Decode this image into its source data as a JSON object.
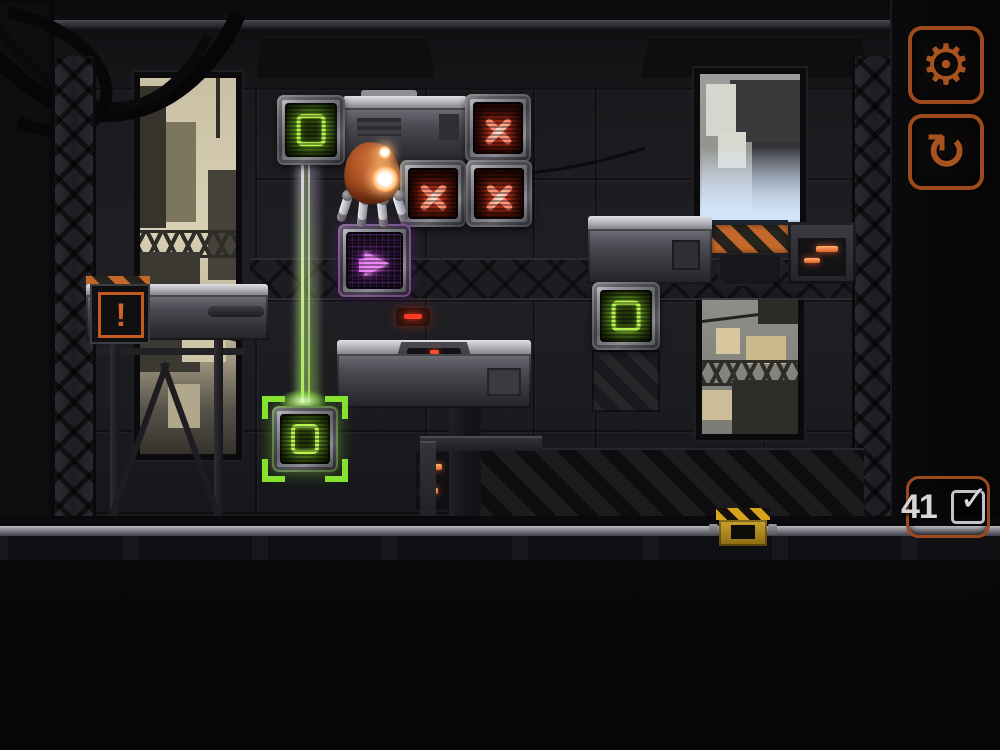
{
  "app": {
    "type": "robot-puzzle-game",
    "view": "level-board"
  },
  "hud": {
    "settings_button": {
      "label": "settings",
      "glyph": "⚙"
    },
    "restart_button": {
      "label": "restart level",
      "glyph": "↻"
    },
    "level_badge": {
      "number": "41",
      "completed": true,
      "check_glyph": "✓"
    }
  },
  "board": {
    "warning_box": {
      "glyph": "!"
    },
    "arrow_crate": {
      "glyph": "▶",
      "direction": "right"
    },
    "entities": [
      {
        "name": "green-symbol-crate",
        "count": 2
      },
      {
        "name": "green-target-socket",
        "count": 1
      },
      {
        "name": "red-x-crate",
        "count": 3
      },
      {
        "name": "purple-arrow-crate",
        "count": 1
      },
      {
        "name": "robot-character",
        "count": 1
      },
      {
        "name": "warning-platform",
        "count": 1
      },
      {
        "name": "machine-platform",
        "count": 2
      },
      {
        "name": "hazard-striped-machine",
        "count": 1
      },
      {
        "name": "laser-beam",
        "count": 1
      },
      {
        "name": "rail-slider",
        "count": 1
      }
    ]
  },
  "colors": {
    "accent_orange": "#a9511f",
    "glow_green": "#a6ef3e",
    "glow_red": "#ff5c42",
    "glow_purple": "#d468ec",
    "hazard_yellow": "#d2a222",
    "background": "#141417"
  }
}
